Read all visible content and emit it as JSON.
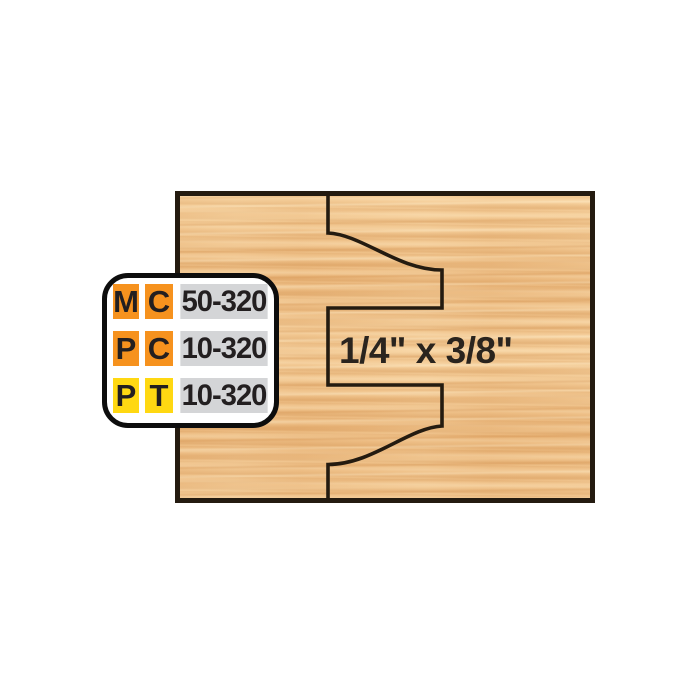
{
  "background_color": "#ffffff",
  "wood_panel": {
    "base_color": "#f1c48c",
    "grain_dark_color": "#dda268",
    "grain_light_color": "#fae0b4",
    "border_color": "#241b10",
    "dimension_label": "1/4\" x 3/8\"",
    "label_color": "#2a241e"
  },
  "profile_line": {
    "color": "#241b10",
    "path": "M 328 193 L 328 233 C 362 234.5 398 270 442 270 L 442 308 L 328 308 L 328 385 L 442 385 L 442 426 C 408 428 372 464.5 328 464.5 L 328 501"
  },
  "spec_table": {
    "background": "#ffffff",
    "border_color": "#0d0d0d",
    "text_color": "#231f20",
    "colors": {
      "orange": "#f6921e",
      "yellow": "#ffd812",
      "gray": "#d4d5d7"
    },
    "rows": [
      {
        "cells": [
          {
            "text": "M",
            "bg": "orange"
          },
          {
            "text": "C",
            "bg": "orange"
          },
          {
            "text": "50-320",
            "bg": "gray"
          }
        ]
      },
      {
        "cells": [
          {
            "text": "P",
            "bg": "orange"
          },
          {
            "text": "C",
            "bg": "orange"
          },
          {
            "text": "10-320",
            "bg": "gray"
          }
        ]
      },
      {
        "cells": [
          {
            "text": "P",
            "bg": "yellow"
          },
          {
            "text": "T",
            "bg": "yellow"
          },
          {
            "text": "10-320",
            "bg": "gray"
          }
        ]
      }
    ]
  }
}
